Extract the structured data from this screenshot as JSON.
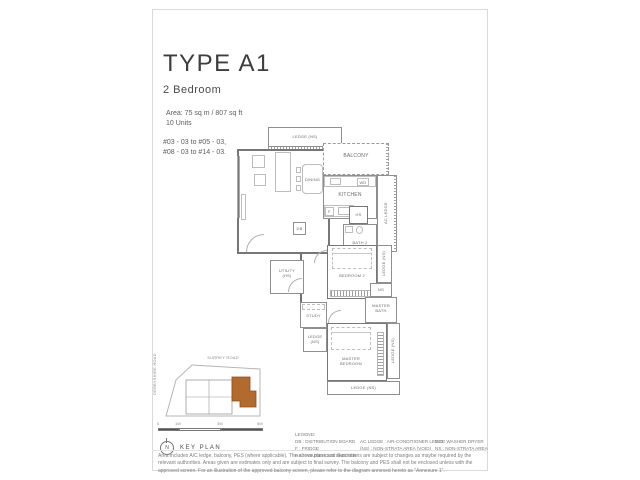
{
  "header": {
    "title": "TYPE A1",
    "subtitle": "2 Bedroom",
    "area": "Area: 75 sq m / 807 sq ft",
    "units": "10 Units",
    "stacks": [
      "#03 - 03 to #05 - 03,",
      "#08 - 03 to #14 - 03."
    ]
  },
  "plan": {
    "labels": {
      "ledge": "LEDGE (NS)",
      "balcony": "BALCONY",
      "dining": "DINING",
      "kitchen": "KITCHEN",
      "ac_ledge": "AC LEDGE",
      "db": "DB",
      "wd": "WD",
      "fridge": "F",
      "hs": "HS",
      "bath2": "BATH 2",
      "utility": "UTILITY (HS)",
      "bedroom2": "BEDROOM 2",
      "study": "STUDY",
      "ns": "NS",
      "master_bath": "MASTER BATH",
      "master_bedroom": "MASTER BEDROOM"
    }
  },
  "keyplan": {
    "title": "KEY PLAN",
    "north_label": "N",
    "road_top": "SURREY ROAD",
    "road_left": "DERBYSHIRE ROAD",
    "scale_labels": [
      "0",
      "1M",
      "3M",
      "5M"
    ],
    "highlight_color": "#b26a2e"
  },
  "legend": {
    "heading": "LEGEND:",
    "col1": [
      "DB : DISTRIBUTION BOARD",
      "F : FRIDGE",
      "HS : HOUSEHOLD SHELTER"
    ],
    "col2": [
      "AC LEDGE : AIR-CONDITIONER LEDGE",
      "(NS) : NON-STRATA AREA (VOID)"
    ],
    "col3": [
      "WD : WASHER DRYER",
      "NS : NON-STRATA AREA"
    ]
  },
  "disclaimer": "Area includes A/C ledge, balcony, PES (where applicable). The above plans and illustrations are subject to changes as maybe required by the relevant authorities. Areas given are estimates only and are subject to final survey. The balcony and PES shall not be enclosed unless with the approved screen. For an illustration of the approved balcony screen, please refer to the diagram annexed hereto as \"Annexure 1\"."
}
